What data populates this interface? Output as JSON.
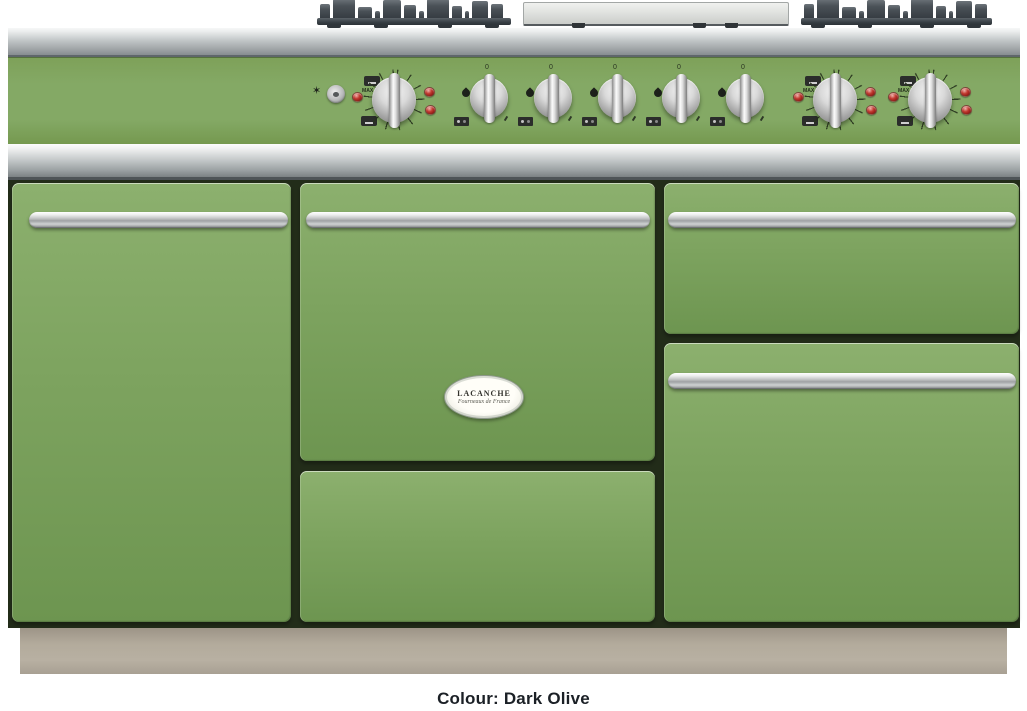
{
  "caption": "Colour: Dark Olive",
  "brand": {
    "name": "LACANCHE",
    "script": "Fourneaux de France"
  },
  "labels": {
    "max": "MAX",
    "zero": "0"
  },
  "controls": {
    "oven_knob_count": 3,
    "burner_knob_count": 5,
    "indicator_light_count": 9,
    "ignition_icon": "spark-star",
    "ignition_button": "metal-push-button"
  },
  "cooktop": {
    "left_grate": "cast-iron-burner-grate",
    "center_plate": "stainless-plancha-plate",
    "right_grate": "cast-iron-burner-grate"
  },
  "colors": {
    "door_green": "#7da35f",
    "door_green_light": "#8cb06e",
    "door_green_dark": "#6d9550",
    "panel_green": "#84a965",
    "stainless_mid": "#bfc4c5",
    "stainless_dark": "#878d90",
    "body_gap": "#222c19",
    "plinth": "#b3ab9c",
    "indicator_red": "#c23a31",
    "grate": "#3e454b",
    "caption_text": "#1b2026"
  }
}
